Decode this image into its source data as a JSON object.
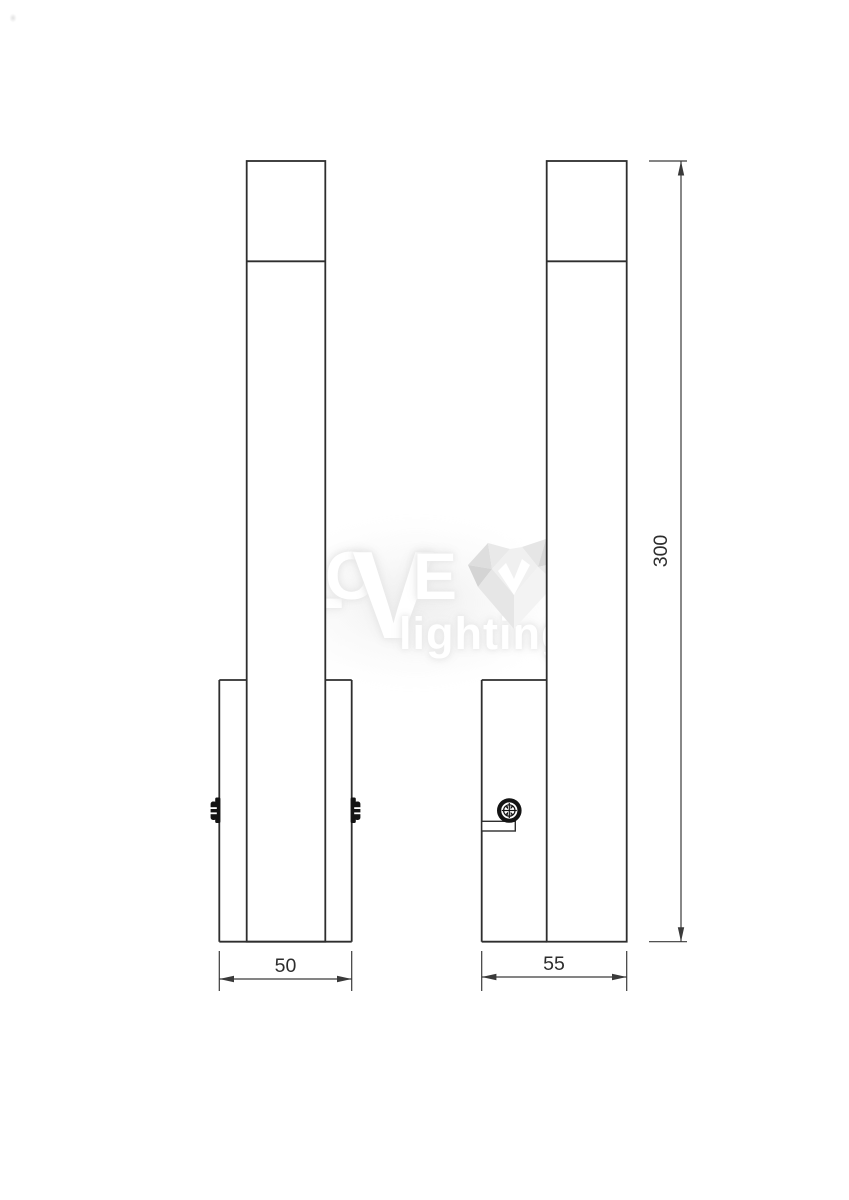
{
  "drawing": {
    "subject": "wall-light two-view dimension drawing",
    "views": {
      "front": {
        "name": "front-view"
      },
      "side": {
        "name": "side-view"
      }
    }
  },
  "dimensions": {
    "front_width": "50",
    "side_depth": "55",
    "height": "300"
  },
  "watermark": {
    "brand_l": "L",
    "brand_o": "O",
    "brand_v": "V",
    "brand_e": "E",
    "brand_word": "lighting"
  },
  "colors": {
    "background": "#ffffff",
    "outline": "#2e2e2e",
    "dimension_line": "#3a3a3a",
    "dimension_text": "#2d2d2d",
    "screw_fill": "#141414",
    "watermark_text": "#ffffff",
    "watermark_glow": "#e6e6e6",
    "heart_light": "#efefef",
    "heart_mid": "#e0e0e0",
    "heart_dark": "#d6d6d6"
  }
}
